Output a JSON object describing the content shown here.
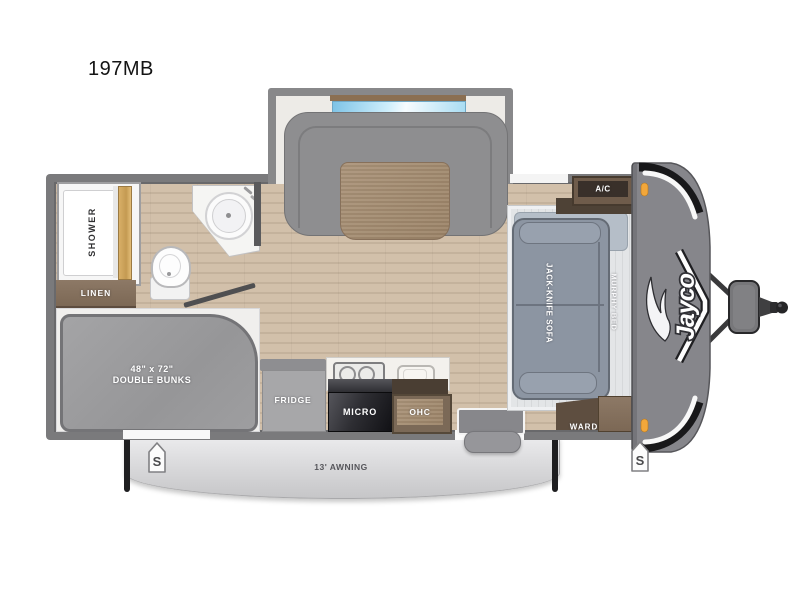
{
  "page": {
    "title": "197MB"
  },
  "floorplan": {
    "model": "197MB",
    "brand": "Jayco",
    "labels": {
      "shower": "SHOWER",
      "linen": "LINEN",
      "bunks_size": "48\" x 72\"",
      "bunks_name": "DOUBLE BUNKS",
      "fridge": "FRIDGE",
      "micro": "MICRO",
      "ohc": "OHC",
      "ac": "A/C",
      "ward": "WARD",
      "sofa": "JACK-KNIFE SOFA",
      "murphy_bed": "MURPHY BED",
      "awning": "13' AWNING",
      "speaker": "S"
    },
    "colors": {
      "wall": "#7a7a7c",
      "floor_wood": "#cdbba5",
      "cabinet_wood": "#75624f",
      "upholstery": "#8d96a3",
      "mattress": "#9e9ea0",
      "front_cap": "#86868b",
      "marker_light": "#f2a73b",
      "window_glass": "#8ecbe9",
      "awning": "#d9d9db"
    }
  }
}
